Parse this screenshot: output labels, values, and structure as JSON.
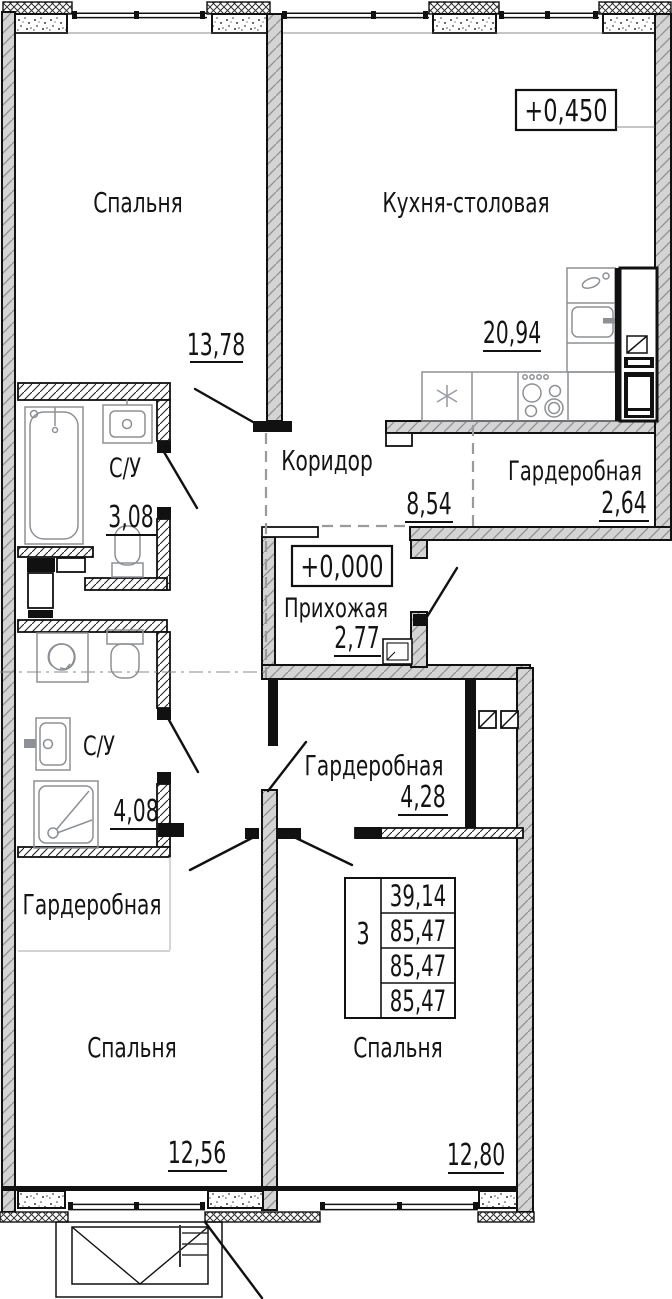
{
  "rooms": [
    {
      "id": "bedroom-1",
      "name": "Спальня",
      "area": "13,78"
    },
    {
      "id": "kitchen",
      "name": "Кухня-столовая",
      "area": "20,94"
    },
    {
      "id": "corridor",
      "name": "Коридор",
      "area": "8,54"
    },
    {
      "id": "bathroom-1",
      "name": "С/У",
      "area": "3,08"
    },
    {
      "id": "wardrobe-1",
      "name": "Гардеробная",
      "area": "2,64"
    },
    {
      "id": "hallway",
      "name": "Прихожая",
      "area": "2,77"
    },
    {
      "id": "bathroom-2",
      "name": "С/У",
      "area": "4,08"
    },
    {
      "id": "wardrobe-2",
      "name": "Гардеробная",
      "area": "4,28"
    },
    {
      "id": "wardrobe-3",
      "name": "Гардеробная",
      "area": ""
    },
    {
      "id": "bedroom-2",
      "name": "Спальня",
      "area": "12,56"
    },
    {
      "id": "bedroom-3",
      "name": "Спальня",
      "area": "12,80"
    }
  ],
  "elevations": {
    "kitchen": "+0,450",
    "hallway": "+0,000"
  },
  "stamp": {
    "room_count": "3",
    "values": [
      "39,14",
      "85,47",
      "85,47",
      "85,47"
    ]
  }
}
